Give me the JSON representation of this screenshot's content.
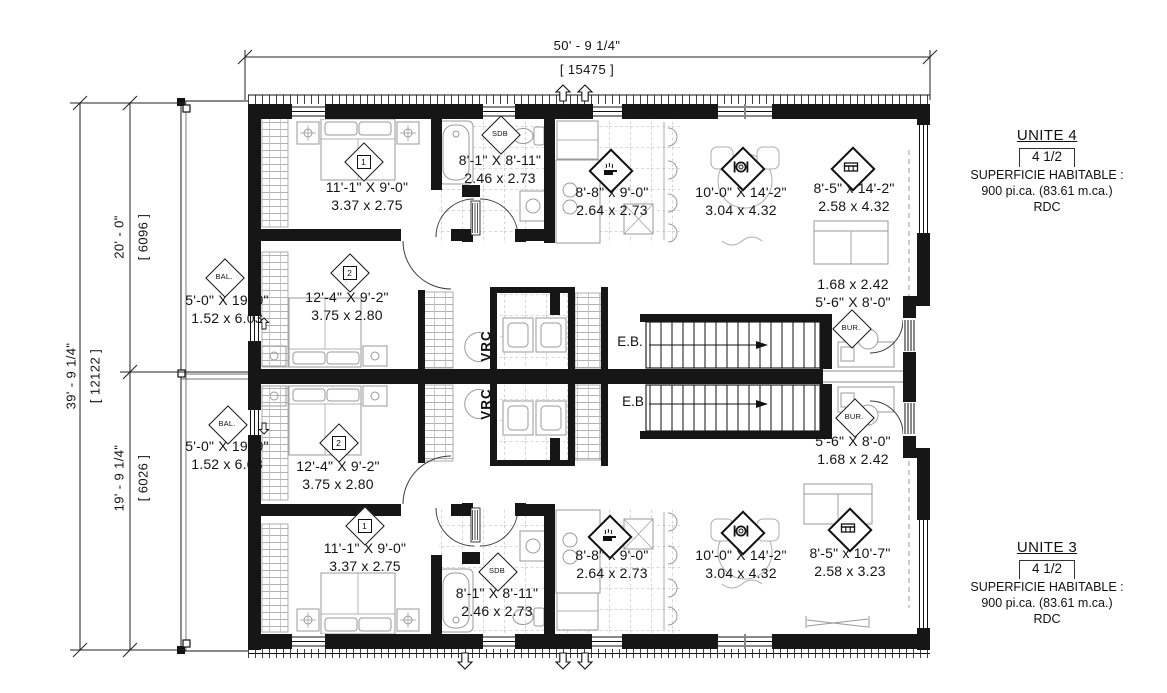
{
  "plan": {
    "dim_width_ft": "50' - 9 1/4\"",
    "dim_width_mm": "[ 15475 ]",
    "dim_height_ft": "39' - 9 1/4\"",
    "dim_height_mm": "[ 12122 ]",
    "dim_u4_ft": "20' - 0\"",
    "dim_u4_mm": "[ 6096 ]",
    "dim_u3_ft": "19' - 9 1/4\"",
    "dim_u3_mm": "[ 6026 ]"
  },
  "unit4": {
    "title": "UNITE 4",
    "layout": "4 1/2",
    "area_label": "SUPERFICIE HABITABLE :",
    "area": "900 pi.ca. (83.61 m.ca.)",
    "level": "RDC",
    "bedroom1": {
      "num": "1",
      "ft": "11'-1\" X 9'-0\"",
      "m": "3.37 x 2.75"
    },
    "bedroom2": {
      "num": "2",
      "ft": "12'-4\" X 9'-2\"",
      "m": "3.75 x 2.80"
    },
    "sdb": {
      "tag": "SDB",
      "ft": "8'-1\" X 8'-11\"",
      "m": "2.46 x 2.73"
    },
    "kitchen": {
      "ft": "8'-8\" x 9'-0\"",
      "m": "2.64 x 2.73"
    },
    "dining": {
      "ft": "10'-0\" X 14'-2\"",
      "m": "3.04 x 4.32"
    },
    "living": {
      "ft": "8'-5\" x 14'-2\"",
      "m": "2.58 x 4.32"
    },
    "balcony": {
      "tag": "BAL.",
      "ft": "5'-0\" X 19'-9\"",
      "m": "1.52 x 6.03"
    },
    "bureau": {
      "tag": "BUR.",
      "line1": "1.68 x 2.42",
      "line2": "5'-6\" X 8'-0\""
    },
    "vrc": "VRC",
    "eb": "E.B."
  },
  "unit3": {
    "title": "UNITE 3",
    "layout": "4 1/2",
    "area_label": "SUPERFICIE HABITABLE :",
    "area": "900 pi.ca. (83.61 m.ca.)",
    "level": "RDC",
    "bedroom1": {
      "num": "1",
      "ft": "11'-1\" X 9'-0\"",
      "m": "3.37 x 2.75"
    },
    "bedroom2": {
      "num": "2",
      "ft": "12'-4\" X 9'-2\"",
      "m": "3.75 x 2.80"
    },
    "sdb": {
      "tag": "SDB",
      "ft": "8'-1\" X 8'-11\"",
      "m": "2.46 x 2.73"
    },
    "kitchen": {
      "ft": "8'-8\" x 9'-0\"",
      "m": "2.64 x 2.73"
    },
    "dining": {
      "ft": "10'-0\" X 14'-2\"",
      "m": "3.04 x 4.32"
    },
    "living": {
      "ft": "8'-5\" x 10'-7\"",
      "m": "2.58 x 3.23"
    },
    "balcony": {
      "tag": "BAL.",
      "ft": "5'-0\" X 19'-9\"",
      "m": "1.52 x 6.03"
    },
    "bureau": {
      "tag": "BUR.",
      "line1": "5'-6\" X 8'-0\"",
      "line2": "1.68 x 2.42"
    },
    "vrc": "VRC",
    "eb": "E.B"
  }
}
